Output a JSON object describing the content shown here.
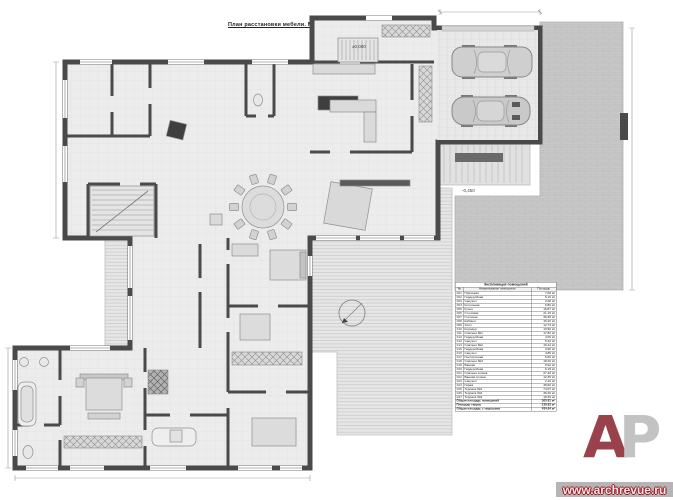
{
  "title": "План расстановки мебели. М 1:50.",
  "legend": {
    "title": "Экспликация помещений",
    "columns": [
      "№",
      "Наименование помещения",
      "Площадь"
    ],
    "rows": [
      {
        "num": "001",
        "name": "Прихожая",
        "area": "7.08 м²"
      },
      {
        "num": "002",
        "name": "Гардеробная",
        "area": "5.10 м²"
      },
      {
        "num": "003",
        "name": "Санузел",
        "area": "2.08 м²"
      },
      {
        "num": "004",
        "name": "Котельная",
        "area": "6.80 м²"
      },
      {
        "num": "005",
        "name": "Кухня",
        "area": "16.87 м²"
      },
      {
        "num": "006",
        "name": "Столовая",
        "area": "21.15 м²"
      },
      {
        "num": "007",
        "name": "Гостиная",
        "area": "36.35 м²"
      },
      {
        "num": "008",
        "name": "Кабинет",
        "area": "15.40 м²"
      },
      {
        "num": "009",
        "name": "Холл",
        "area": "12.74 м²"
      },
      {
        "num": "010",
        "name": "Коридор",
        "area": "10.56 м²"
      },
      {
        "num": "011",
        "name": "Спальня №1",
        "area": "17.80 м²"
      },
      {
        "num": "012",
        "name": "Гардеробная",
        "area": "4.05 м²"
      },
      {
        "num": "013",
        "name": "Санузел",
        "area": "5.32 м²"
      },
      {
        "num": "014",
        "name": "Спальня №2",
        "area": "16.44 м²"
      },
      {
        "num": "015",
        "name": "Гардеробная",
        "area": "3.90 м²"
      },
      {
        "num": "016",
        "name": "Санузел",
        "area": "4.85 м²"
      },
      {
        "num": "017",
        "name": "Постирочная",
        "area": "5.60 м²"
      },
      {
        "num": "018",
        "name": "Спальня №3",
        "area": "18.20 м²"
      },
      {
        "num": "019",
        "name": "Ванная",
        "area": "8.92 м²"
      },
      {
        "num": "020",
        "name": "Гардеробная",
        "area": "6.15 м²"
      },
      {
        "num": "021",
        "name": "Спальня хозяев",
        "area": "27.40 м²"
      },
      {
        "num": "022",
        "name": "Ванная хозяев",
        "area": "12.35 м²"
      },
      {
        "num": "023",
        "name": "Санузел",
        "area": "2.10 м²"
      },
      {
        "num": "024",
        "name": "Гараж",
        "area": "38.60 м²"
      }
    ],
    "terrace_rows": [
      {
        "num": "025",
        "name": "Терраса №1",
        "area": "74.07 м²"
      },
      {
        "num": "026",
        "name": "Терраса №2",
        "area": "36.40 м²"
      },
      {
        "num": "027",
        "name": "Терраса №3",
        "area": "18.36 м²"
      }
    ],
    "totals": [
      {
        "label": "Общая площадь помещений",
        "value": "305.81 м²"
      },
      {
        "label": "Площадь террас",
        "value": "128.83 м²"
      },
      {
        "label": "Общая площадь с террасами",
        "value": "434.64 м²"
      }
    ]
  },
  "plan": {
    "elevation_entrance": "±0,000",
    "elevation_terrace": "-0,450"
  },
  "logo": {
    "letter_a": "А",
    "letter_p": "Р",
    "website": "www.archrevue.ru",
    "accent_color": "#9a424b"
  },
  "colors": {
    "walls": "#4a4a4a",
    "floor": "#ececec",
    "paving": "#c7c7c7",
    "deck": "#e6e6e6"
  }
}
